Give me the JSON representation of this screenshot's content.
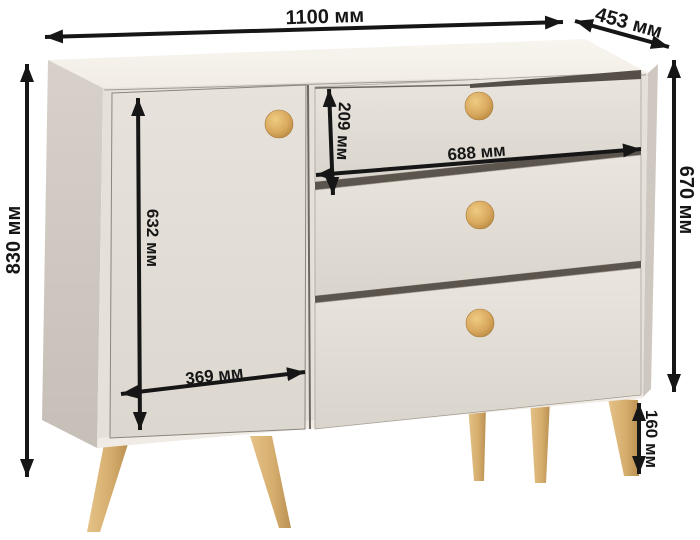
{
  "diagram": {
    "kind": "furniture dimension diagram",
    "subject": "chest of drawers with one door and three drawers",
    "unit": "мм",
    "dimensions": {
      "overall_width": {
        "value": 1100,
        "label": "1100 мм"
      },
      "overall_depth": {
        "value": 453,
        "label": "453 мм"
      },
      "overall_height": {
        "value": 830,
        "label": "830 мм"
      },
      "body_height": {
        "value": 670,
        "label": "670 мм"
      },
      "door_height": {
        "value": 632,
        "label": "632 мм"
      },
      "door_width": {
        "value": 369,
        "label": "369 мм"
      },
      "top_drawer_height": {
        "value": 209,
        "label": "209 мм"
      },
      "drawer_width": {
        "value": 688,
        "label": "688 мм"
      },
      "leg_height": {
        "value": 160,
        "label": "160 мм"
      }
    },
    "furniture": {
      "door_count": 1,
      "drawer_count": 3,
      "knob_count": 4,
      "visible_leg_count": 5
    },
    "colors": {
      "background": "#ffffff",
      "annotation_ink": "#161616",
      "body_front": "#e5e0d9",
      "body_top": "#f6f2ec",
      "body_side": "#cfc8c0",
      "gap_shadow": "#5b554d",
      "wood_knob": "#d9a95f",
      "wood_leg": "#d7b277"
    }
  }
}
